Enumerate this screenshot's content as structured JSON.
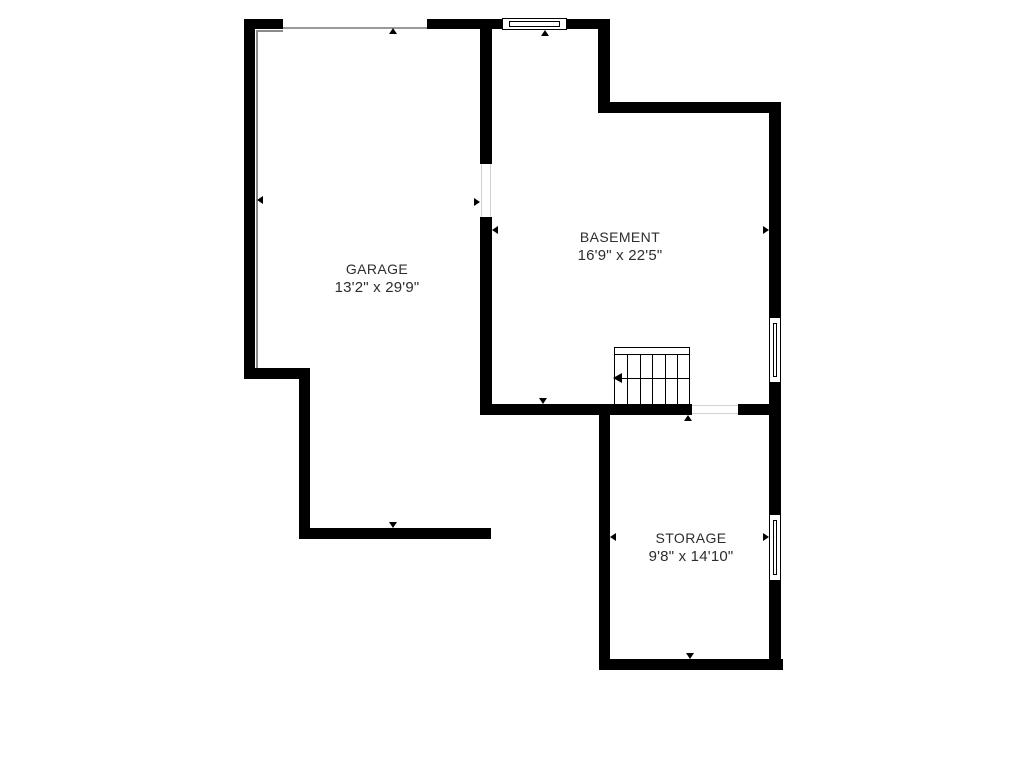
{
  "floorplan": {
    "background_color": "#ffffff",
    "wall_color": "#000000",
    "accent_line_color": "#8a8a8a",
    "text_color": "#2d2d2d",
    "rooms": {
      "garage": {
        "name": "GARAGE",
        "dimensions": "13'2\" x 29'9\""
      },
      "basement": {
        "name": "BASEMENT",
        "dimensions": "16'9\" x 22'5\""
      },
      "storage": {
        "name": "STORAGE",
        "dimensions": "9'8\" x 14'10\""
      }
    },
    "symbols": {
      "stairs": "stairs-with-run-arrow",
      "windows": [
        "top-wall-window",
        "basement-right-window",
        "storage-right-window"
      ],
      "openings": [
        "garage-door-opening",
        "basement-doorway",
        "basement-bottom-doorway"
      ],
      "measurement_marker": "small-black-triangle"
    }
  }
}
